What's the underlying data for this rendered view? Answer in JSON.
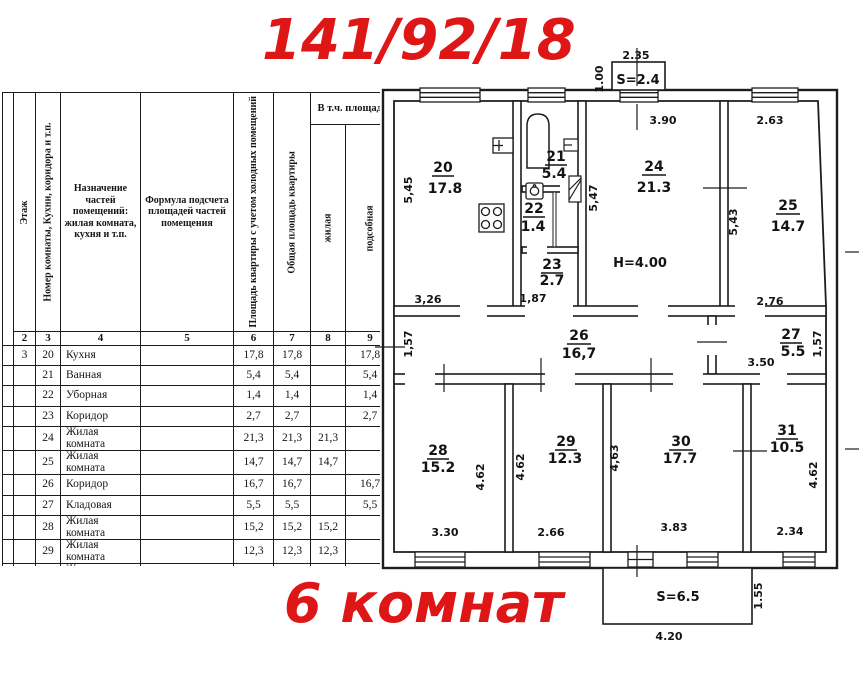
{
  "title": "141/92/18",
  "subtitle": "6 комнат",
  "accent_color": "#df1616",
  "table": {
    "span_header": "В т.ч. площадь",
    "columns": [
      {
        "num": "2",
        "title": "Этаж"
      },
      {
        "num": "3",
        "title": "Номер комнаты, Кухни, коридора и т.п."
      },
      {
        "num": "4",
        "title": "Назначение частей помещений: жилая комната, кухня и т.п."
      },
      {
        "num": "5",
        "title": "Формула подсчета площадей частей помещения"
      },
      {
        "num": "6",
        "title": "Площадь квартиры с учетом холодных помещений"
      },
      {
        "num": "7",
        "title": "Общая площадь квартиры"
      },
      {
        "num": "8",
        "title": "жилая"
      },
      {
        "num": "9",
        "title": "подсобная"
      }
    ],
    "rows": [
      {
        "floor": "3",
        "num": "20",
        "name": "Кухня",
        "formula": "",
        "s1": "17,8",
        "s2": "17,8",
        "zh": "",
        "pod": "17,8"
      },
      {
        "floor": "",
        "num": "21",
        "name": "Ванная",
        "formula": "",
        "s1": "5,4",
        "s2": "5,4",
        "zh": "",
        "pod": "5,4"
      },
      {
        "floor": "",
        "num": "22",
        "name": "Уборная",
        "formula": "",
        "s1": "1,4",
        "s2": "1,4",
        "zh": "",
        "pod": "1,4"
      },
      {
        "floor": "",
        "num": "23",
        "name": "Коридор",
        "formula": "",
        "s1": "2,7",
        "s2": "2,7",
        "zh": "",
        "pod": "2,7"
      },
      {
        "floor": "",
        "num": "24",
        "name": "Жилая комната",
        "formula": "",
        "s1": "21,3",
        "s2": "21,3",
        "zh": "21,3",
        "pod": ""
      },
      {
        "floor": "",
        "num": "25",
        "name": "Жилая комната",
        "formula": "",
        "s1": "14,7",
        "s2": "14,7",
        "zh": "14,7",
        "pod": ""
      },
      {
        "floor": "",
        "num": "26",
        "name": "Коридор",
        "formula": "",
        "s1": "16,7",
        "s2": "16,7",
        "zh": "",
        "pod": "16,7"
      },
      {
        "floor": "",
        "num": "27",
        "name": "Кладовая",
        "formula": "",
        "s1": "5,5",
        "s2": "5,5",
        "zh": "",
        "pod": "5,5"
      },
      {
        "floor": "",
        "num": "28",
        "name": "Жилая комната",
        "formula": "",
        "s1": "15,2",
        "s2": "15,2",
        "zh": "15,2",
        "pod": ""
      },
      {
        "floor": "",
        "num": "29",
        "name": "Жилая комната",
        "formula": "",
        "s1": "12,3",
        "s2": "12,3",
        "zh": "12,3",
        "pod": ""
      },
      {
        "floor": "",
        "num": "30",
        "name": "Жилая комната",
        "formula": "",
        "s1": "17,7",
        "s2": "17,7",
        "zh": "17,7",
        "pod": ""
      },
      {
        "floor": "",
        "num": "31",
        "name": "Жилая комната",
        "formula": "",
        "s1": "10,5",
        "s2": "10,5",
        "zh": "10,5",
        "pod": ""
      },
      {
        "floor": "",
        "num": "",
        "name": "Балкон",
        "formula": "",
        "s1": "0,7",
        "s2": "",
        "zh": "",
        "pod": ""
      },
      {
        "floor": "",
        "num": "",
        "name": "Балкон",
        "formula": "",
        "s1": "2,0",
        "s2": "",
        "zh": "",
        "pod": ""
      },
      {
        "floor": "",
        "num": "",
        "name": "Итого:",
        "formula": "",
        "s1": "143,9",
        "s2": "141,2",
        "zh": "91,7",
        "pod": "49,5"
      }
    ]
  },
  "plan": {
    "r20": {
      "n": "20",
      "area": "17.8",
      "w": "3,26",
      "h": "5,45"
    },
    "r21": {
      "n": "21",
      "area": "5.4"
    },
    "r22": {
      "n": "22",
      "area": "1.4"
    },
    "r23": {
      "n": "23",
      "area": "2.7",
      "w": "1,87"
    },
    "r24": {
      "n": "24",
      "area": "21.3",
      "w": "3.90",
      "h": "5,47",
      "note": "H=4.00"
    },
    "r25": {
      "n": "25",
      "area": "14.7",
      "w": "2.63",
      "w2": "2.76",
      "h": "5,43"
    },
    "r26": {
      "n": "26",
      "area": "16,7",
      "h": "1,57"
    },
    "r27": {
      "n": "27",
      "area": "5.5",
      "w": "3.50",
      "h": "1,57"
    },
    "r28": {
      "n": "28",
      "area": "15.2",
      "w": "3.30",
      "h": "4.62"
    },
    "r29": {
      "n": "29",
      "area": "12.3",
      "w": "2.66",
      "h": "4.62",
      "h2": "4,63"
    },
    "r30": {
      "n": "30",
      "area": "17.7",
      "w": "3.83"
    },
    "r31": {
      "n": "31",
      "area": "10.5",
      "w": "2.34",
      "h": "4.62"
    },
    "balcony_top": {
      "s": "S=2.4",
      "w": "2.35",
      "h": "1.00"
    },
    "balcony_bottom": {
      "s": "S=6.5",
      "w": "4.20",
      "h": "1.55"
    }
  }
}
